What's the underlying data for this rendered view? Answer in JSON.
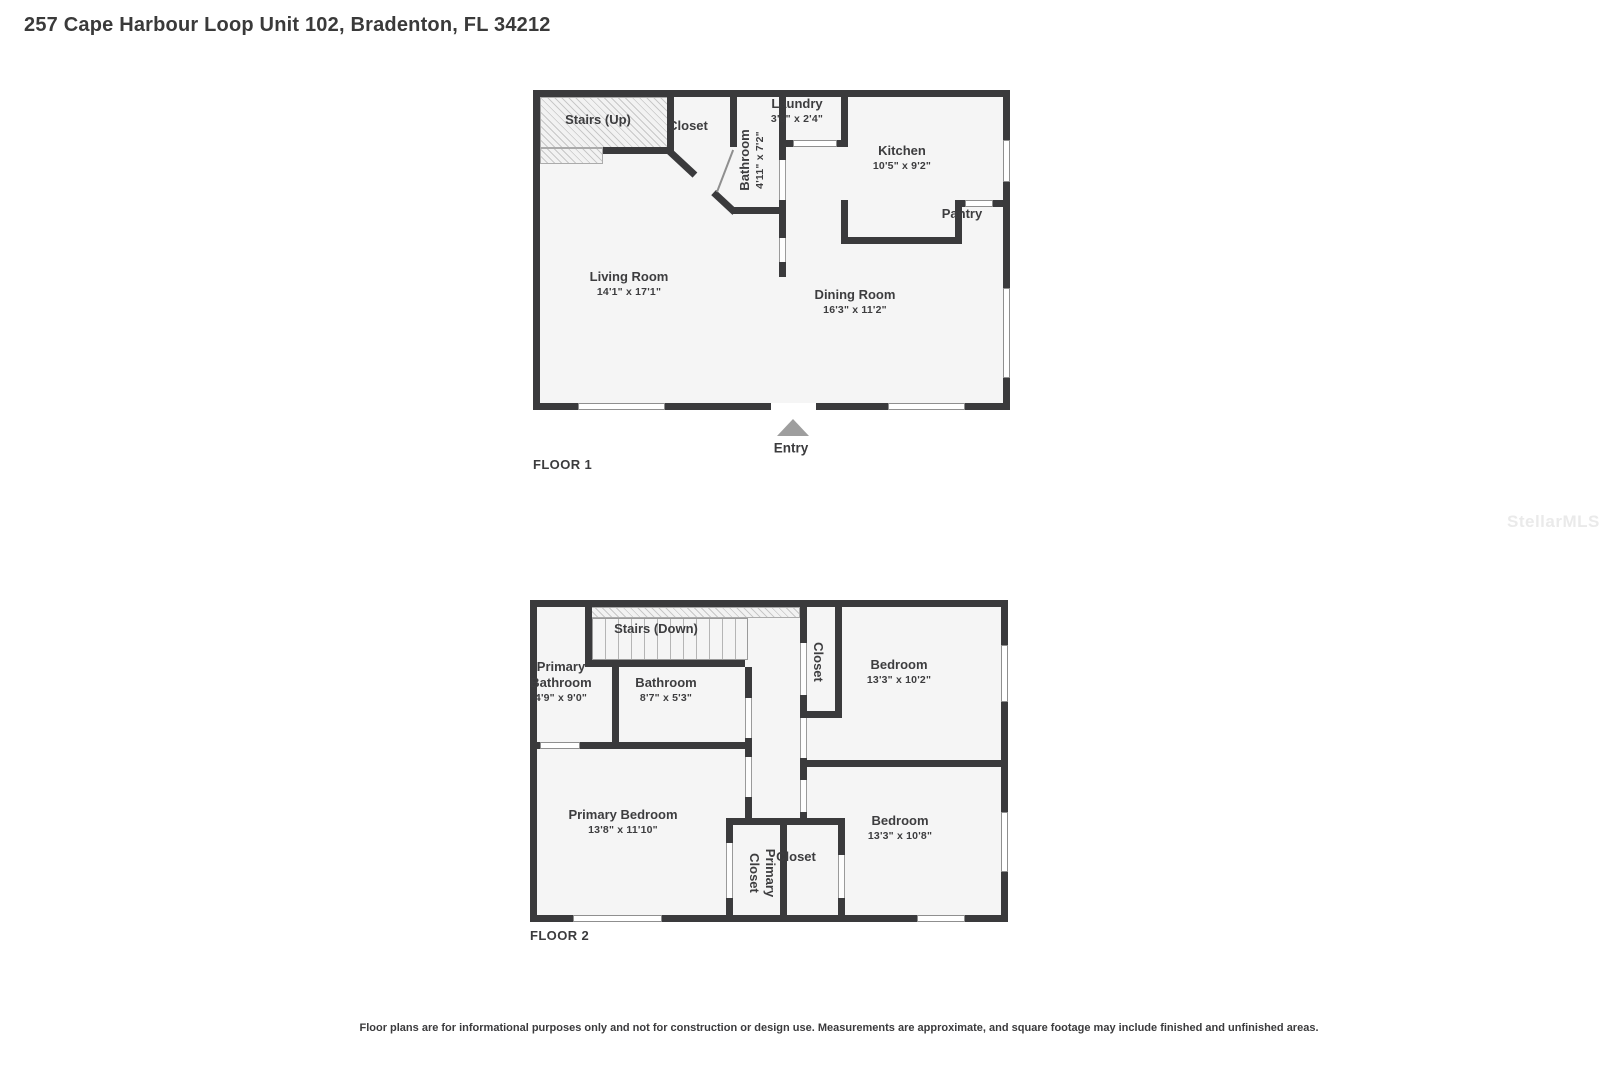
{
  "page": {
    "title": "257 Cape Harbour Loop Unit 102, Bradenton, FL 34212",
    "watermark": "StellarMLS",
    "disclaimer": "Floor plans are for informational purposes only and not for construction or design use. Measurements are approximate, and square footage may include finished and unfinished areas."
  },
  "floor1": {
    "label": "FLOOR 1",
    "entry_label": "Entry",
    "rooms": {
      "stairs": {
        "name": "Stairs (Up)"
      },
      "closet": {
        "name": "Closet"
      },
      "bathroom": {
        "name": "Bathroom",
        "dims": "4'11\" x 7'2\""
      },
      "laundry": {
        "name": "Laundry",
        "dims": "3'8\" x 2'4\""
      },
      "kitchen": {
        "name": "Kitchen",
        "dims": "10'5\" x 9'2\""
      },
      "pantry": {
        "name": "Pantry"
      },
      "living_room": {
        "name": "Living Room",
        "dims": "14'1\" x 17'1\""
      },
      "dining_room": {
        "name": "Dining Room",
        "dims": "16'3\" x 11'2\""
      }
    }
  },
  "floor2": {
    "label": "FLOOR 2",
    "rooms": {
      "stairs": {
        "name": "Stairs (Down)"
      },
      "primary_bathroom": {
        "name": "Primary Bathroom",
        "dims": "4'9\" x 9'0\""
      },
      "bathroom": {
        "name": "Bathroom",
        "dims": "8'7\" x 5'3\""
      },
      "closet_upper": {
        "name": "Closet"
      },
      "bedroom_upper": {
        "name": "Bedroom",
        "dims": "13'3\" x 10'2\""
      },
      "primary_bedroom": {
        "name": "Primary Bedroom",
        "dims": "13'8\" x 11'10\""
      },
      "primary_closet": {
        "name": "Primary Closet"
      },
      "closet_lower": {
        "name": "Closet"
      },
      "bedroom_lower": {
        "name": "Bedroom",
        "dims": "13'3\" x 10'8\""
      }
    }
  },
  "colors": {
    "wall": "#3a3a3c",
    "room_fill": "#f5f5f5",
    "text": "#3d3d3f",
    "entry_arrow": "#9e9e9e",
    "watermark": "#eaeaea"
  }
}
